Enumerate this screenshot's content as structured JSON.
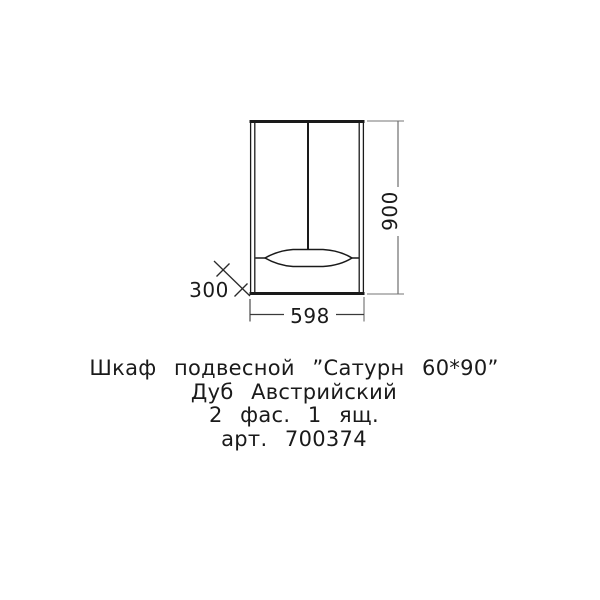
{
  "page": {
    "background": "#ffffff"
  },
  "drawing": {
    "line_color": "#1a1a1a",
    "dim_line_color": "#8a8a8a",
    "dimensions": {
      "height_mm": "900",
      "width_mm": "598",
      "depth_mm": "300"
    }
  },
  "caption": {
    "lines": [
      "Шкаф подвесной ”Сатурн 60*90”",
      "Дуб Австрийский",
      "2 фас. 1 ящ.",
      "арт. 700374"
    ]
  }
}
